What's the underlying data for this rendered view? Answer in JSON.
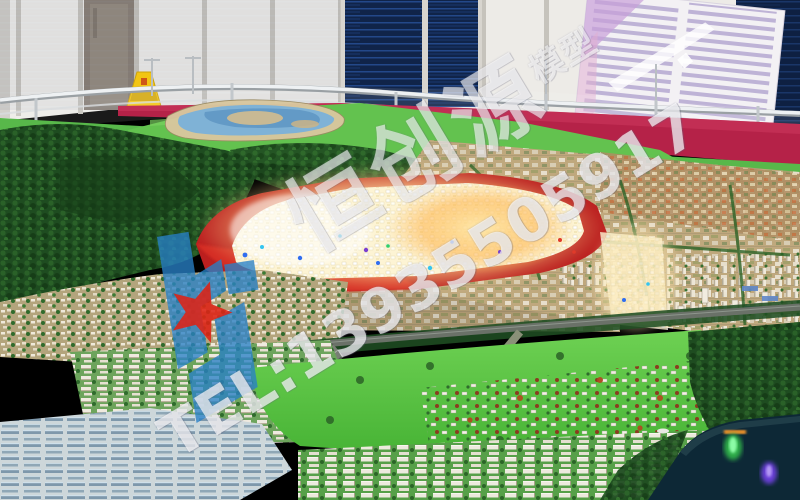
{
  "watermark": {
    "company_text": "恒创源",
    "company_suffix": "模型",
    "tel_text": "TEL:13935505917"
  },
  "palette": {
    "wm-text": "rgba(255,255,255,0.74)",
    "logo-blue": "rgba(40,128,198,0.78)",
    "star-red": "rgba(222,34,22,0.88)",
    "carpet-red": "#b52248",
    "turf-green": "#58b84a",
    "glow-yellow": "#ffd98e",
    "led-blue": "#2f6df0",
    "pond-glow-cyan": "#27d6f0"
  }
}
